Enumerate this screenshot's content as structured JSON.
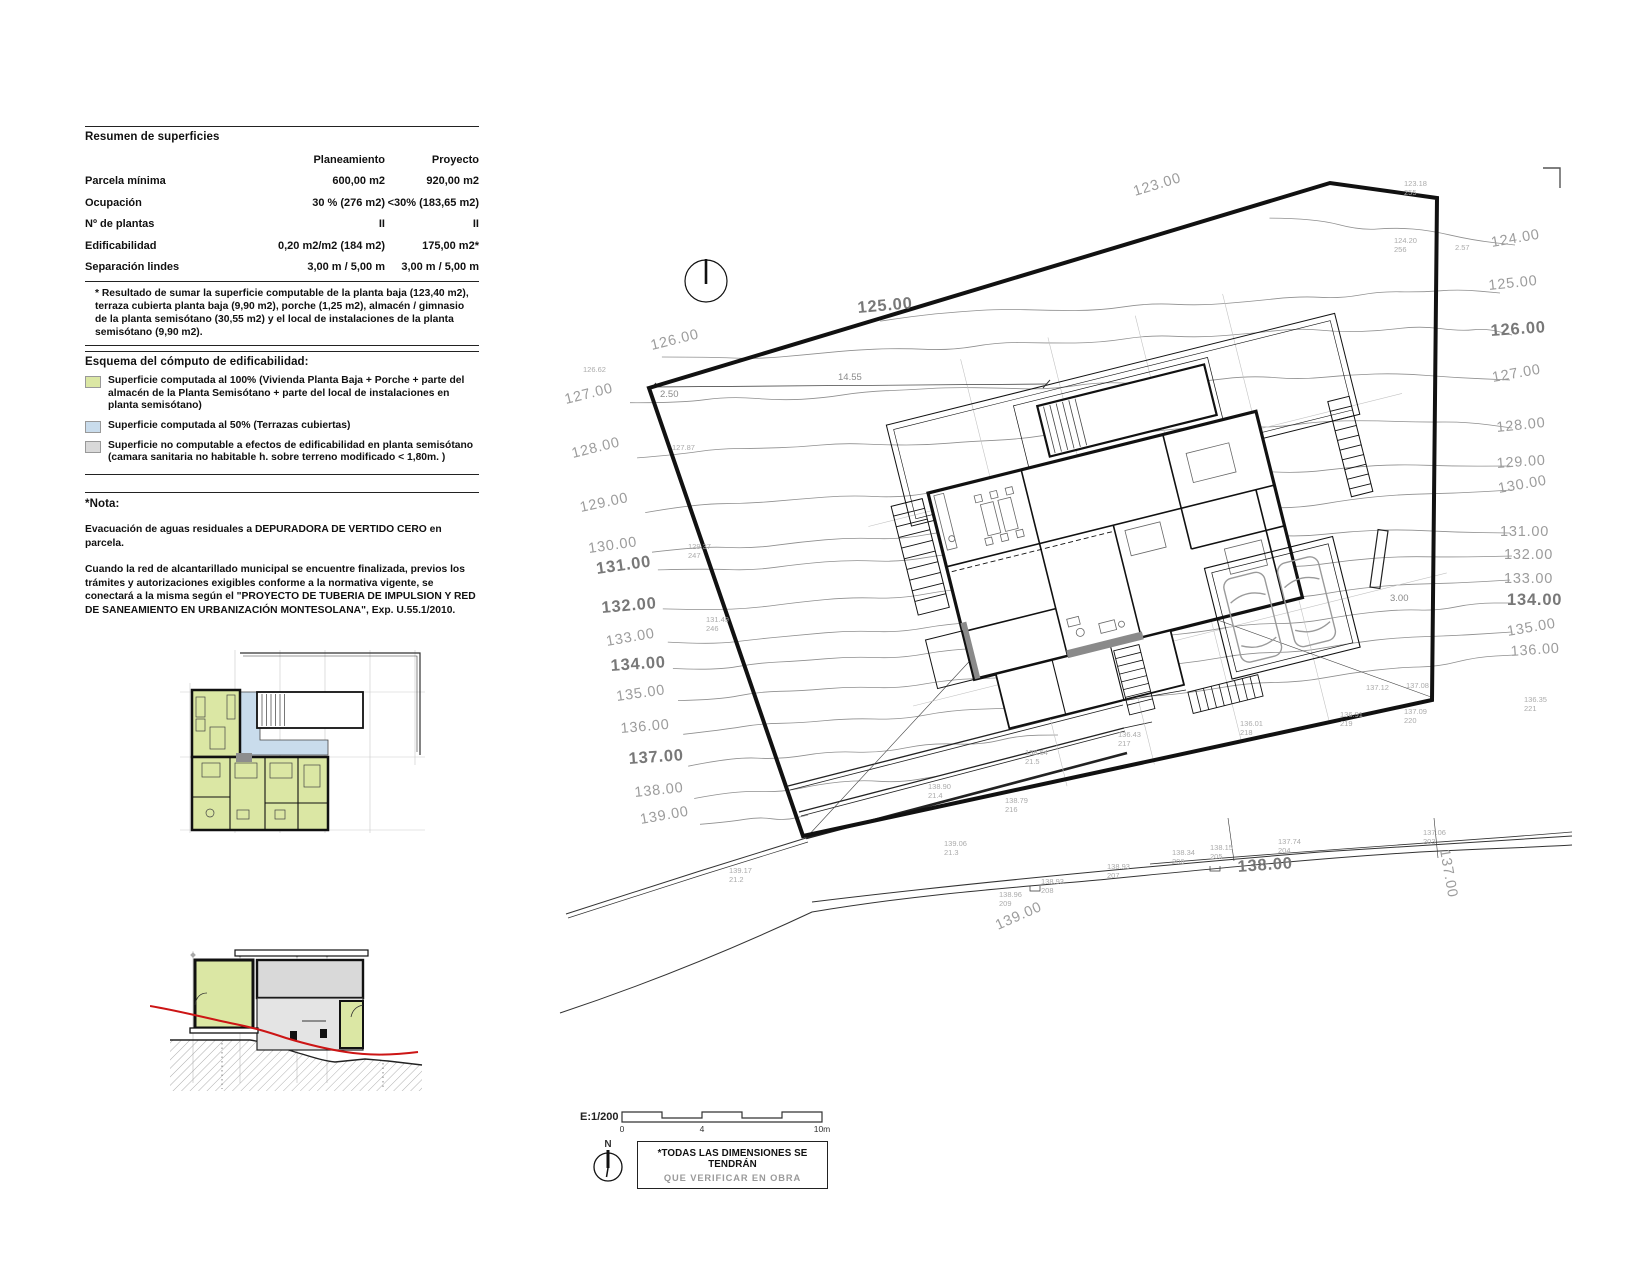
{
  "panel": {
    "table": {
      "title": "Resumen de superficies",
      "columns": [
        "Planeamiento",
        "Proyecto"
      ],
      "rows": [
        {
          "label": "Parcela mínima",
          "p": "600,00 m2",
          "pr": "920,00 m2"
        },
        {
          "label": "Ocupación",
          "p": "30 % (276 m2)",
          "pr": "<30% (183,65 m2)"
        },
        {
          "label": "Nº de plantas",
          "p": "II",
          "pr": "II"
        },
        {
          "label": "Edificabilidad",
          "p": "0,20 m2/m2 (184 m2)",
          "pr": "175,00 m2*"
        },
        {
          "label": "Separación lindes",
          "p": "3,00 m / 5,00 m",
          "pr": "3,00 m / 5,00 m"
        }
      ],
      "footnote": "* Resultado de sumar la superficie computable de la planta baja (123,40 m2), terraza cubierta planta baja (9,90 m2), porche (1,25 m2), almacén / gimnasio de la planta semisótano (30,55 m2) y el local de instalaciones de la planta semisótano (9,90 m2)."
    },
    "legend": {
      "title": "Esquema del cómputo de edificabilidad:",
      "items": [
        {
          "color": "#dbe7a4",
          "text": "Superficie computada al 100% (Vivienda Planta Baja + Porche + parte del almacén de la Planta Semisótano + parte del local de instalaciones en planta semisótano)"
        },
        {
          "color": "#c9dcec",
          "text": "Superficie computada al 50% (Terrazas cubiertas)"
        },
        {
          "color": "#d9d9d9",
          "text": "Superficie no computable a efectos de edificabilidad en planta semisótano (camara sanitaria no habitable h. sobre terreno modificado < 1,80m. )"
        }
      ]
    },
    "nota": {
      "title": "*Nota:",
      "p1": "Evacuación de aguas residuales a DEPURADORA DE VERTIDO CERO en parcela.",
      "p2": "Cuando la red de alcantarillado municipal se encuentre finalizada, previos los trámites y autorizaciones exigibles conforme a la normativa vigente, se conectará a la misma según el \"PROYECTO DE TUBERIA DE IMPULSION Y RED DE SANEAMIENTO EN URBANIZACIÓN MONTESOLANA\", Exp. U.55.1/2010."
    }
  },
  "site_plan": {
    "scale_label": "E:1/200",
    "scale_ticks": [
      "0",
      "4",
      "10m"
    ],
    "north_label": "N",
    "note": {
      "line1": "*TODAS LAS DIMENSIONES SE TENDRÁN",
      "line2": "QUE VERIFICAR EN OBRA"
    },
    "colors": {
      "contour": "#8f8f8f",
      "label": "#9c9c9c",
      "label_bold": "#787878",
      "terrain_red": "#cc1515"
    },
    "contour_labels": [
      {
        "t": "126.00",
        "x": 652,
        "y": 350,
        "r": -14
      },
      {
        "t": "127.00",
        "x": 566,
        "y": 404,
        "r": -14
      },
      {
        "t": "128.00",
        "x": 573,
        "y": 458,
        "r": -14
      },
      {
        "t": "129.00",
        "x": 581,
        "y": 512,
        "r": -12
      },
      {
        "t": "130.00",
        "x": 589,
        "y": 553,
        "r": -8
      },
      {
        "t": "131.00",
        "x": 597,
        "y": 574,
        "r": -8,
        "b": 1
      },
      {
        "t": "132.00",
        "x": 602,
        "y": 613,
        "r": -5,
        "b": 1
      },
      {
        "t": "133.00",
        "x": 607,
        "y": 646,
        "r": -10
      },
      {
        "t": "134.00",
        "x": 611,
        "y": 671,
        "r": -4,
        "b": 1
      },
      {
        "t": "135.00",
        "x": 617,
        "y": 701,
        "r": -8
      },
      {
        "t": "136.00",
        "x": 621,
        "y": 733,
        "r": -5
      },
      {
        "t": "137.00",
        "x": 629,
        "y": 764,
        "r": -4,
        "b": 1
      },
      {
        "t": "138.00",
        "x": 635,
        "y": 797,
        "r": -6
      },
      {
        "t": "139.00",
        "x": 641,
        "y": 824,
        "r": -10
      },
      {
        "t": "124.00",
        "x": 1492,
        "y": 247,
        "r": -10
      },
      {
        "t": "125.00",
        "x": 1489,
        "y": 290,
        "r": -6
      },
      {
        "t": "126.00",
        "x": 1491,
        "y": 336,
        "r": -4,
        "b": 1
      },
      {
        "t": "127.00",
        "x": 1493,
        "y": 382,
        "r": -10
      },
      {
        "t": "128.00",
        "x": 1497,
        "y": 432,
        "r": -6
      },
      {
        "t": "129.00",
        "x": 1497,
        "y": 468,
        "r": -4
      },
      {
        "t": "130.00",
        "x": 1499,
        "y": 493,
        "r": -10
      },
      {
        "t": "131.00",
        "x": 1500,
        "y": 536,
        "r": 0
      },
      {
        "t": "132.00",
        "x": 1504,
        "y": 559,
        "r": 0
      },
      {
        "t": "133.00",
        "x": 1504,
        "y": 583,
        "r": 0
      },
      {
        "t": "134.00",
        "x": 1507,
        "y": 605,
        "r": 0,
        "b": 1
      },
      {
        "t": "135.00",
        "x": 1508,
        "y": 636,
        "r": -10
      },
      {
        "t": "136.00",
        "x": 1511,
        "y": 656,
        "r": -4
      },
      {
        "t": "123.00",
        "x": 1135,
        "y": 196,
        "r": -17
      },
      {
        "t": "125.00",
        "x": 858,
        "y": 313,
        "r": -5,
        "b": 1
      },
      {
        "t": "138.00",
        "x": 1238,
        "y": 872,
        "r": -4,
        "b": 1
      },
      {
        "t": "139.00",
        "x": 998,
        "y": 930,
        "r": -24
      },
      {
        "t": "137.00",
        "x": 1440,
        "y": 850,
        "r": 80
      }
    ],
    "spot_labels": [
      {
        "v": "126.62",
        "s": "",
        "x": 583,
        "y": 372
      },
      {
        "v": "123.18",
        "s": "255",
        "x": 1404,
        "y": 186
      },
      {
        "v": "124.20",
        "s": "256",
        "x": 1394,
        "y": 243
      },
      {
        "v": "2.57",
        "s": "",
        "x": 1455,
        "y": 250
      },
      {
        "v": "127.87",
        "s": "",
        "x": 672,
        "y": 450
      },
      {
        "v": "129.37",
        "s": "247",
        "x": 688,
        "y": 549
      },
      {
        "v": "131.49",
        "s": "246",
        "x": 706,
        "y": 622
      },
      {
        "v": "137.12",
        "s": "",
        "x": 1366,
        "y": 690
      },
      {
        "v": "137.08",
        "s": "",
        "x": 1406,
        "y": 688
      },
      {
        "v": "137.09",
        "s": "220",
        "x": 1404,
        "y": 714
      },
      {
        "v": "136.35",
        "s": "221",
        "x": 1524,
        "y": 702
      },
      {
        "v": "136.43",
        "s": "217",
        "x": 1118,
        "y": 737
      },
      {
        "v": "136.01",
        "s": "218",
        "x": 1240,
        "y": 726
      },
      {
        "v": "136.91",
        "s": "219",
        "x": 1340,
        "y": 717
      },
      {
        "v": "139.06",
        "s": "21.3",
        "x": 944,
        "y": 846
      },
      {
        "v": "139.17",
        "s": "21.2",
        "x": 729,
        "y": 873
      },
      {
        "v": "138.90",
        "s": "21.4",
        "x": 928,
        "y": 789
      },
      {
        "v": "138.64",
        "s": "21.5",
        "x": 1025,
        "y": 755
      },
      {
        "v": "138.79",
        "s": "216",
        "x": 1005,
        "y": 803
      },
      {
        "v": "138.96",
        "s": "209",
        "x": 999,
        "y": 897
      },
      {
        "v": "138.93",
        "s": "208",
        "x": 1041,
        "y": 884
      },
      {
        "v": "138.93",
        "s": "207",
        "x": 1107,
        "y": 869
      },
      {
        "v": "138.34",
        "s": "206",
        "x": 1172,
        "y": 855
      },
      {
        "v": "138.15",
        "s": "205",
        "x": 1210,
        "y": 850
      },
      {
        "v": "137.74",
        "s": "204",
        "x": 1278,
        "y": 844
      },
      {
        "v": "137.06",
        "s": "203",
        "x": 1423,
        "y": 835
      }
    ],
    "dims": [
      {
        "t": "14.55",
        "x": 838,
        "y": 380
      },
      {
        "t": "2.50",
        "x": 660,
        "y": 397
      },
      {
        "t": "3.00",
        "x": 1390,
        "y": 601
      }
    ],
    "contours": [
      {
        "pts": [
          [
            1270,
            215
          ],
          [
            1360,
            228
          ],
          [
            1430,
            232
          ],
          [
            1515,
            245
          ]
        ]
      },
      {
        "pts": [
          [
            880,
            318
          ],
          [
            1000,
            312
          ],
          [
            1150,
            306
          ],
          [
            1300,
            298
          ],
          [
            1420,
            290
          ],
          [
            1500,
            293
          ]
        ]
      },
      {
        "pts": [
          [
            662,
            360
          ],
          [
            850,
            352
          ],
          [
            1000,
            345
          ],
          [
            1150,
            338
          ],
          [
            1300,
            330
          ],
          [
            1460,
            328
          ],
          [
            1512,
            335
          ]
        ]
      },
      {
        "pts": [
          [
            630,
            402
          ],
          [
            780,
            398
          ],
          [
            950,
            390
          ],
          [
            1100,
            385
          ],
          [
            1250,
            378
          ],
          [
            1400,
            374
          ],
          [
            1510,
            380
          ]
        ]
      },
      {
        "pts": [
          [
            637,
            455
          ],
          [
            800,
            448
          ],
          [
            970,
            440
          ],
          [
            1120,
            432
          ],
          [
            1270,
            425
          ],
          [
            1420,
            420
          ],
          [
            1512,
            428
          ]
        ]
      },
      {
        "pts": [
          [
            645,
            510
          ],
          [
            800,
            500
          ],
          [
            950,
            492
          ],
          [
            1100,
            483
          ],
          [
            1250,
            473
          ],
          [
            1400,
            465
          ],
          [
            1510,
            466
          ]
        ]
      },
      {
        "pts": [
          [
            652,
            552
          ],
          [
            800,
            543
          ],
          [
            950,
            533
          ],
          [
            1100,
            522
          ],
          [
            1250,
            510
          ],
          [
            1400,
            495
          ],
          [
            1512,
            490
          ]
        ]
      },
      {
        "pts": [
          [
            658,
            572
          ],
          [
            800,
            565
          ],
          [
            950,
            556
          ],
          [
            1100,
            546
          ],
          [
            1250,
            536
          ],
          [
            1400,
            530
          ],
          [
            1510,
            533
          ]
        ]
      },
      {
        "pts": [
          [
            663,
            612
          ],
          [
            800,
            603
          ],
          [
            950,
            592
          ],
          [
            1100,
            580
          ],
          [
            1250,
            568
          ],
          [
            1400,
            557
          ],
          [
            1512,
            556
          ]
        ]
      },
      {
        "pts": [
          [
            668,
            645
          ],
          [
            800,
            636
          ],
          [
            950,
            626
          ],
          [
            1100,
            614
          ],
          [
            1250,
            600
          ],
          [
            1400,
            585
          ],
          [
            1510,
            580
          ]
        ]
      },
      {
        "pts": [
          [
            673,
            670
          ],
          [
            800,
            662
          ],
          [
            950,
            652
          ],
          [
            1100,
            640
          ],
          [
            1250,
            626
          ],
          [
            1400,
            610
          ],
          [
            1513,
            603
          ]
        ]
      },
      {
        "pts": [
          [
            678,
            700
          ],
          [
            800,
            692
          ],
          [
            950,
            682
          ],
          [
            1100,
            670
          ],
          [
            1250,
            655
          ],
          [
            1400,
            638
          ],
          [
            1512,
            632
          ]
        ]
      },
      {
        "pts": [
          [
            683,
            732
          ],
          [
            800,
            724
          ],
          [
            950,
            713
          ],
          [
            1100,
            700
          ],
          [
            1250,
            685
          ],
          [
            1400,
            668
          ],
          [
            1515,
            655
          ]
        ]
      },
      {
        "pts": [
          [
            688,
            763
          ],
          [
            780,
            757
          ],
          [
            880,
            750
          ],
          [
            980,
            742
          ],
          [
            1058,
            735
          ]
        ]
      },
      {
        "pts": [
          [
            694,
            796
          ],
          [
            780,
            790
          ],
          [
            860,
            783
          ],
          [
            938,
            776
          ]
        ]
      },
      {
        "pts": [
          [
            700,
            824
          ],
          [
            760,
            820
          ],
          [
            808,
            815
          ]
        ]
      }
    ]
  }
}
